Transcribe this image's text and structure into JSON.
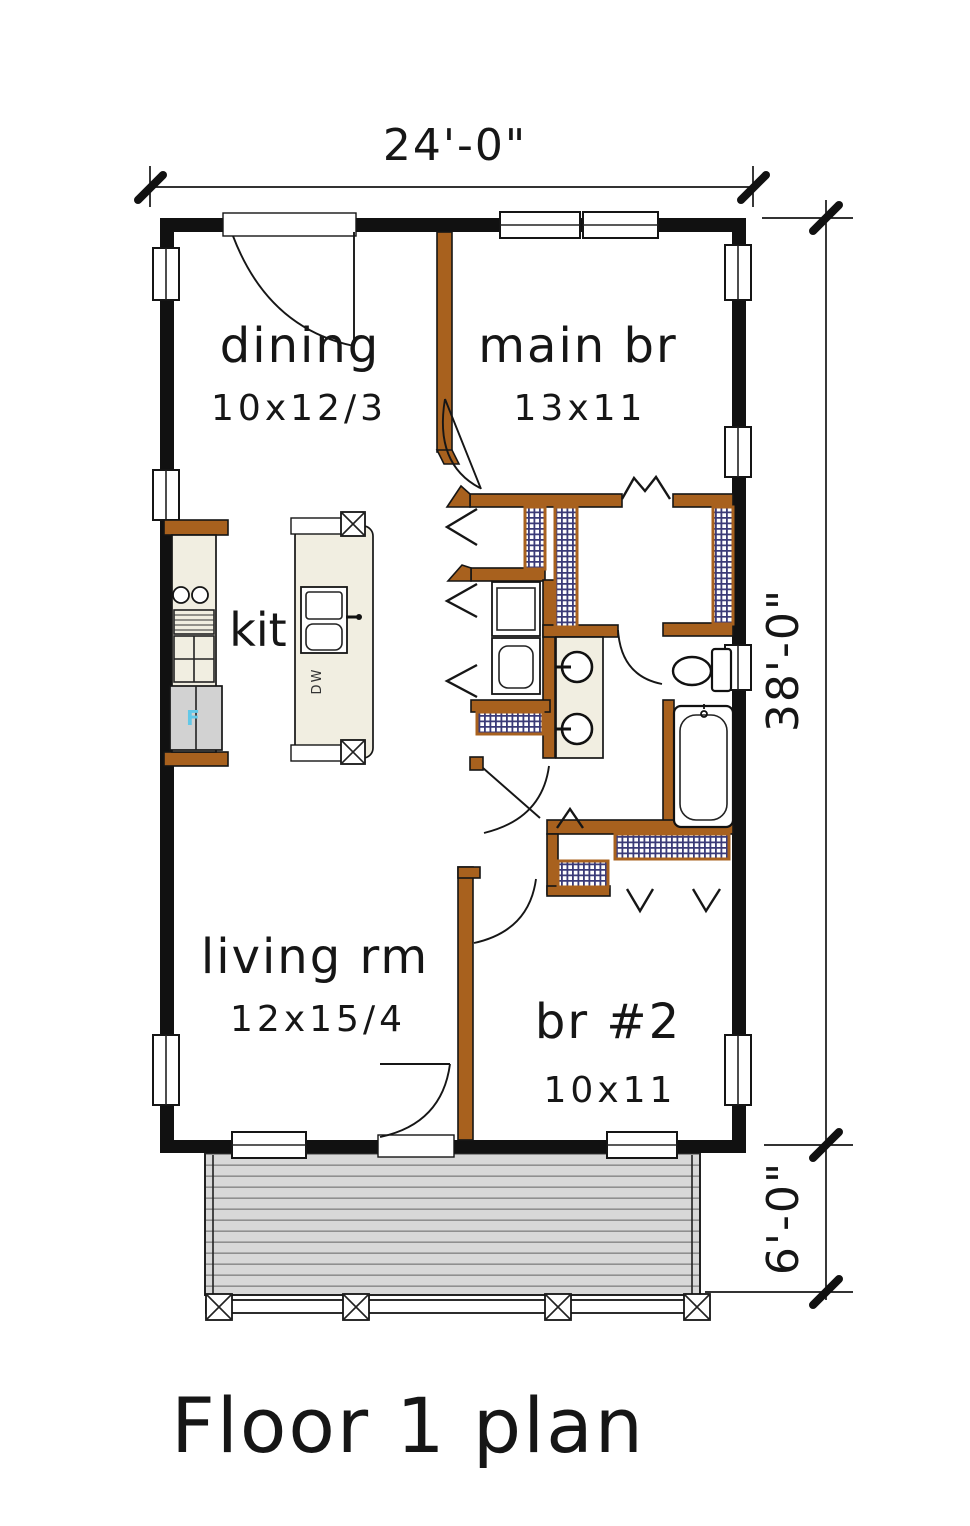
{
  "page": {
    "title": "Floor 1 plan"
  },
  "dimensions": {
    "width_label": "24'-0\"",
    "height_label": "38'-0\"",
    "porch_label": "6'-0\""
  },
  "rooms": [
    {
      "name": "dining",
      "size": "10x12/3"
    },
    {
      "name": "main br",
      "size": "13x11"
    },
    {
      "name": "kit",
      "size": ""
    },
    {
      "name": "living rm",
      "size": "12x15/4"
    },
    {
      "name": "br #2",
      "size": "10x11"
    }
  ],
  "fixtures": {
    "fridge_label": "F",
    "dishwasher_label": "DW"
  },
  "colors": {
    "wall_exterior": "#111111",
    "wall_interior": "#A8611E",
    "hatch": "#3B3B78",
    "porch_fill": "#D8D8D8",
    "fixture_cream": "#F1EEE1",
    "fridge_label_color": "#62C8E8"
  }
}
